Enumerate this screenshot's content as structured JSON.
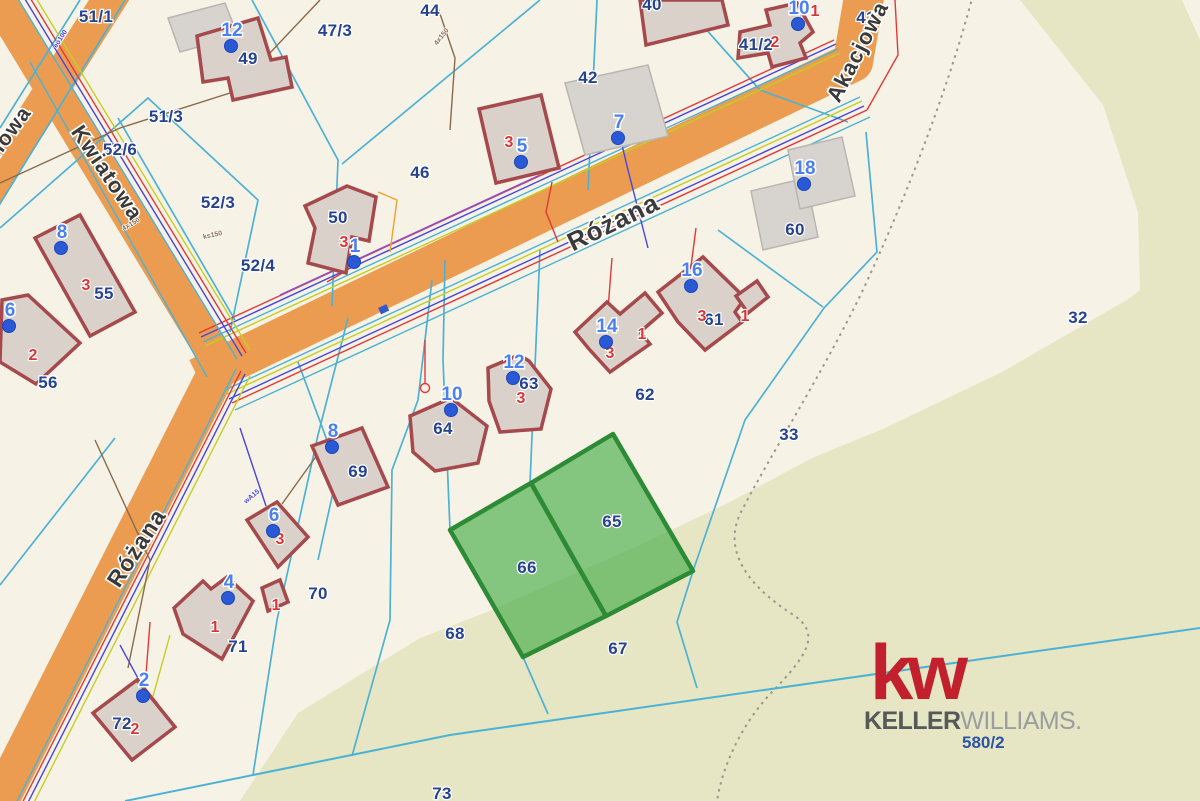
{
  "map": {
    "colors": {
      "background": "#f7f2e6",
      "forest": "#e6e6c4",
      "road": "#ec9c50",
      "parcel_line": "#4cb2d4",
      "parcel_label": "#26438f",
      "address_number": "#dc3434",
      "building_fill": "#d9d1ca",
      "building_border": "#a6494c",
      "gray_building_fill": "#d7d3cf",
      "marker_dot": "#2a59d6",
      "marker_text": "#4b80f0",
      "highlight_fill": "#4caf50",
      "highlight_border": "#2e8b35"
    },
    "street_labels": [
      {
        "text": "Różana",
        "x": 617,
        "y": 230,
        "rot": -26,
        "size": 26
      },
      {
        "text": "Różana",
        "x": 143,
        "y": 552,
        "rot": -57,
        "size": 23
      },
      {
        "text": "Kwiatowa",
        "x": 101,
        "y": 177,
        "rot": 56,
        "size": 22
      },
      {
        "text": "Jaśminowa",
        "x": -4,
        "y": 162,
        "rot": -54,
        "size": 21
      },
      {
        "text": "Akacjowa",
        "x": 864,
        "y": 55,
        "rot": -63,
        "size": 22
      }
    ],
    "parcel_labels": [
      {
        "text": "44",
        "x": 430,
        "y": 16
      },
      {
        "text": "47/3",
        "x": 335,
        "y": 36
      },
      {
        "text": "49",
        "x": 248,
        "y": 64
      },
      {
        "text": "51/3",
        "x": 166,
        "y": 122
      },
      {
        "text": "52/6",
        "x": 120,
        "y": 155
      },
      {
        "text": "52/3",
        "x": 218,
        "y": 208
      },
      {
        "text": "46",
        "x": 420,
        "y": 178
      },
      {
        "text": "42",
        "x": 588,
        "y": 83
      },
      {
        "text": "41/2",
        "x": 756,
        "y": 50
      },
      {
        "text": "40",
        "x": 652,
        "y": 10
      },
      {
        "text": "41",
        "x": 866,
        "y": 23
      },
      {
        "text": "52/4",
        "x": 258,
        "y": 271
      },
      {
        "text": "50",
        "x": 338,
        "y": 223
      },
      {
        "text": "55",
        "x": 104,
        "y": 299
      },
      {
        "text": "56",
        "x": 48,
        "y": 388
      },
      {
        "text": "60",
        "x": 795,
        "y": 235
      },
      {
        "text": "61",
        "x": 714,
        "y": 325
      },
      {
        "text": "62",
        "x": 645,
        "y": 400
      },
      {
        "text": "63",
        "x": 529,
        "y": 389
      },
      {
        "text": "64",
        "x": 443,
        "y": 434
      },
      {
        "text": "69",
        "x": 358,
        "y": 477
      },
      {
        "text": "65",
        "x": 612,
        "y": 527
      },
      {
        "text": "66",
        "x": 527,
        "y": 573
      },
      {
        "text": "67",
        "x": 618,
        "y": 654
      },
      {
        "text": "68",
        "x": 455,
        "y": 639
      },
      {
        "text": "70",
        "x": 318,
        "y": 599
      },
      {
        "text": "71",
        "x": 238,
        "y": 652
      },
      {
        "text": "72",
        "x": 122,
        "y": 729
      },
      {
        "text": "73",
        "x": 442,
        "y": 799
      },
      {
        "text": "32",
        "x": 1078,
        "y": 323
      },
      {
        "text": "33",
        "x": 789,
        "y": 440
      }
    ],
    "parcel_labels_under": [
      {
        "text": "51/1",
        "x": 96,
        "y": 22
      }
    ],
    "address_numbers": [
      {
        "text": "3",
        "x": 509,
        "y": 147
      },
      {
        "text": "2",
        "x": 775,
        "y": 47
      },
      {
        "text": "1",
        "x": 815,
        "y": 16
      },
      {
        "text": "3",
        "x": 344,
        "y": 247
      },
      {
        "text": "3",
        "x": 86,
        "y": 290
      },
      {
        "text": "2",
        "x": 33,
        "y": 360
      },
      {
        "text": "3",
        "x": 521,
        "y": 403
      },
      {
        "text": "3",
        "x": 610,
        "y": 358
      },
      {
        "text": "1",
        "x": 642,
        "y": 339
      },
      {
        "text": "3",
        "x": 702,
        "y": 321
      },
      {
        "text": "1",
        "x": 745,
        "y": 321
      },
      {
        "text": "3",
        "x": 280,
        "y": 544
      },
      {
        "text": "1",
        "x": 215,
        "y": 632
      },
      {
        "text": "1",
        "x": 276,
        "y": 610
      },
      {
        "text": "2",
        "x": 135,
        "y": 734
      }
    ],
    "markers": [
      {
        "label": "12",
        "x": 232,
        "y": 36
      },
      {
        "label": "5",
        "x": 522,
        "y": 152
      },
      {
        "label": "7",
        "x": 619,
        "y": 128
      },
      {
        "label": "10",
        "x": 799,
        "y": 14
      },
      {
        "label": "18",
        "x": 805,
        "y": 174
      },
      {
        "label": "1",
        "x": 355,
        "y": 252
      },
      {
        "label": "8",
        "x": 62,
        "y": 238
      },
      {
        "label": "6",
        "x": 10,
        "y": 316
      },
      {
        "label": "16",
        "x": 692,
        "y": 276
      },
      {
        "label": "14",
        "x": 607,
        "y": 332
      },
      {
        "label": "12",
        "x": 514,
        "y": 368
      },
      {
        "label": "10",
        "x": 452,
        "y": 400
      },
      {
        "label": "8",
        "x": 333,
        "y": 437
      },
      {
        "label": "6",
        "x": 274,
        "y": 521
      },
      {
        "label": "4",
        "x": 229,
        "y": 588
      },
      {
        "label": "2",
        "x": 144,
        "y": 686
      }
    ],
    "utility_labels": [
      {
        "text": "eo100",
        "x": 62,
        "y": 40,
        "rot": -57,
        "color": "#4745e0"
      },
      {
        "text": "4x150",
        "x": 132,
        "y": 226,
        "rot": -30,
        "color": "#8a6a48"
      },
      {
        "text": "ks150",
        "x": 213,
        "y": 237,
        "rot": -12,
        "color": "#8a6a48"
      },
      {
        "text": "4x150",
        "x": 443,
        "y": 38,
        "rot": -52,
        "color": "#8a6a48"
      },
      {
        "text": "wA15",
        "x": 253,
        "y": 498,
        "rot": -40,
        "color": "#4745e0"
      }
    ],
    "highlighted_parcels": [
      "65",
      "66"
    ]
  },
  "logo": {
    "kw": "kw",
    "keller": "KELLER",
    "williams": "WILLIAMS.",
    "ref": "580/2"
  }
}
